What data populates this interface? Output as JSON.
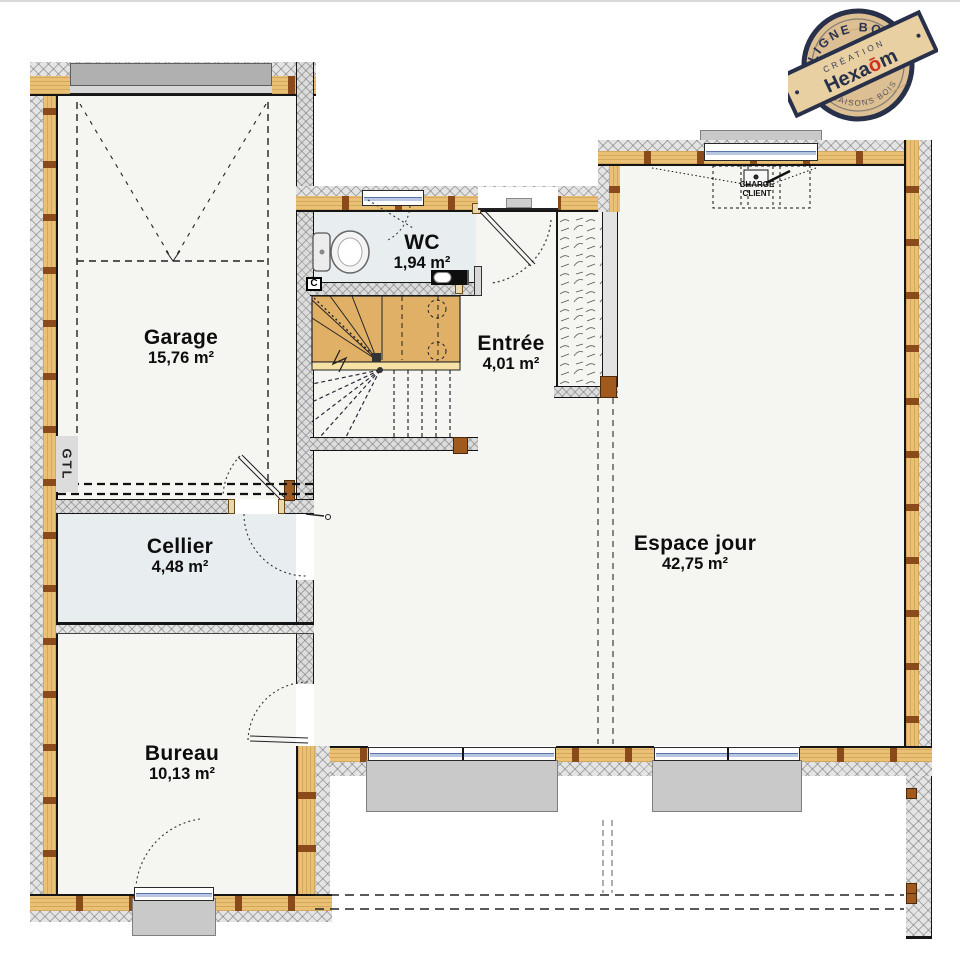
{
  "stamp": {
    "top_arc": "LIGNE BOIS",
    "bottom_arc": "MAISONS BOIS",
    "band_label": "CRÉATION",
    "brand_pre": "Hexa",
    "brand_o": "ō",
    "brand_post": "m"
  },
  "rooms": [
    {
      "name": "Garage",
      "area": "15,76 m²"
    },
    {
      "name": "WC",
      "area": "1,94 m²"
    },
    {
      "name": "Entrée",
      "area": "4,01 m²"
    },
    {
      "name": "Cellier",
      "area": "4,48 m²"
    },
    {
      "name": "Espace jour",
      "area": "42,75 m²"
    },
    {
      "name": "Bureau",
      "area": "10,13 m²"
    }
  ],
  "annotations": {
    "gtl": "GTL",
    "charge_line1": "CHARGE",
    "charge_line2": "CLIENT",
    "heater_mark": "C"
  },
  "colors": {
    "wood_wall": "#e9c074",
    "stud_brown": "#8a4a1a",
    "hatch_gray": "#e4e4e4",
    "stair_wood": "#e0b067",
    "glass_blue": "#b9c6e2",
    "sill_gray": "#c9c9c9",
    "garage_door_gray": "#b0b0b0",
    "wet_floor": "#e8edf0",
    "stamp_navy": "#28304a",
    "stamp_red": "#cc3322"
  }
}
